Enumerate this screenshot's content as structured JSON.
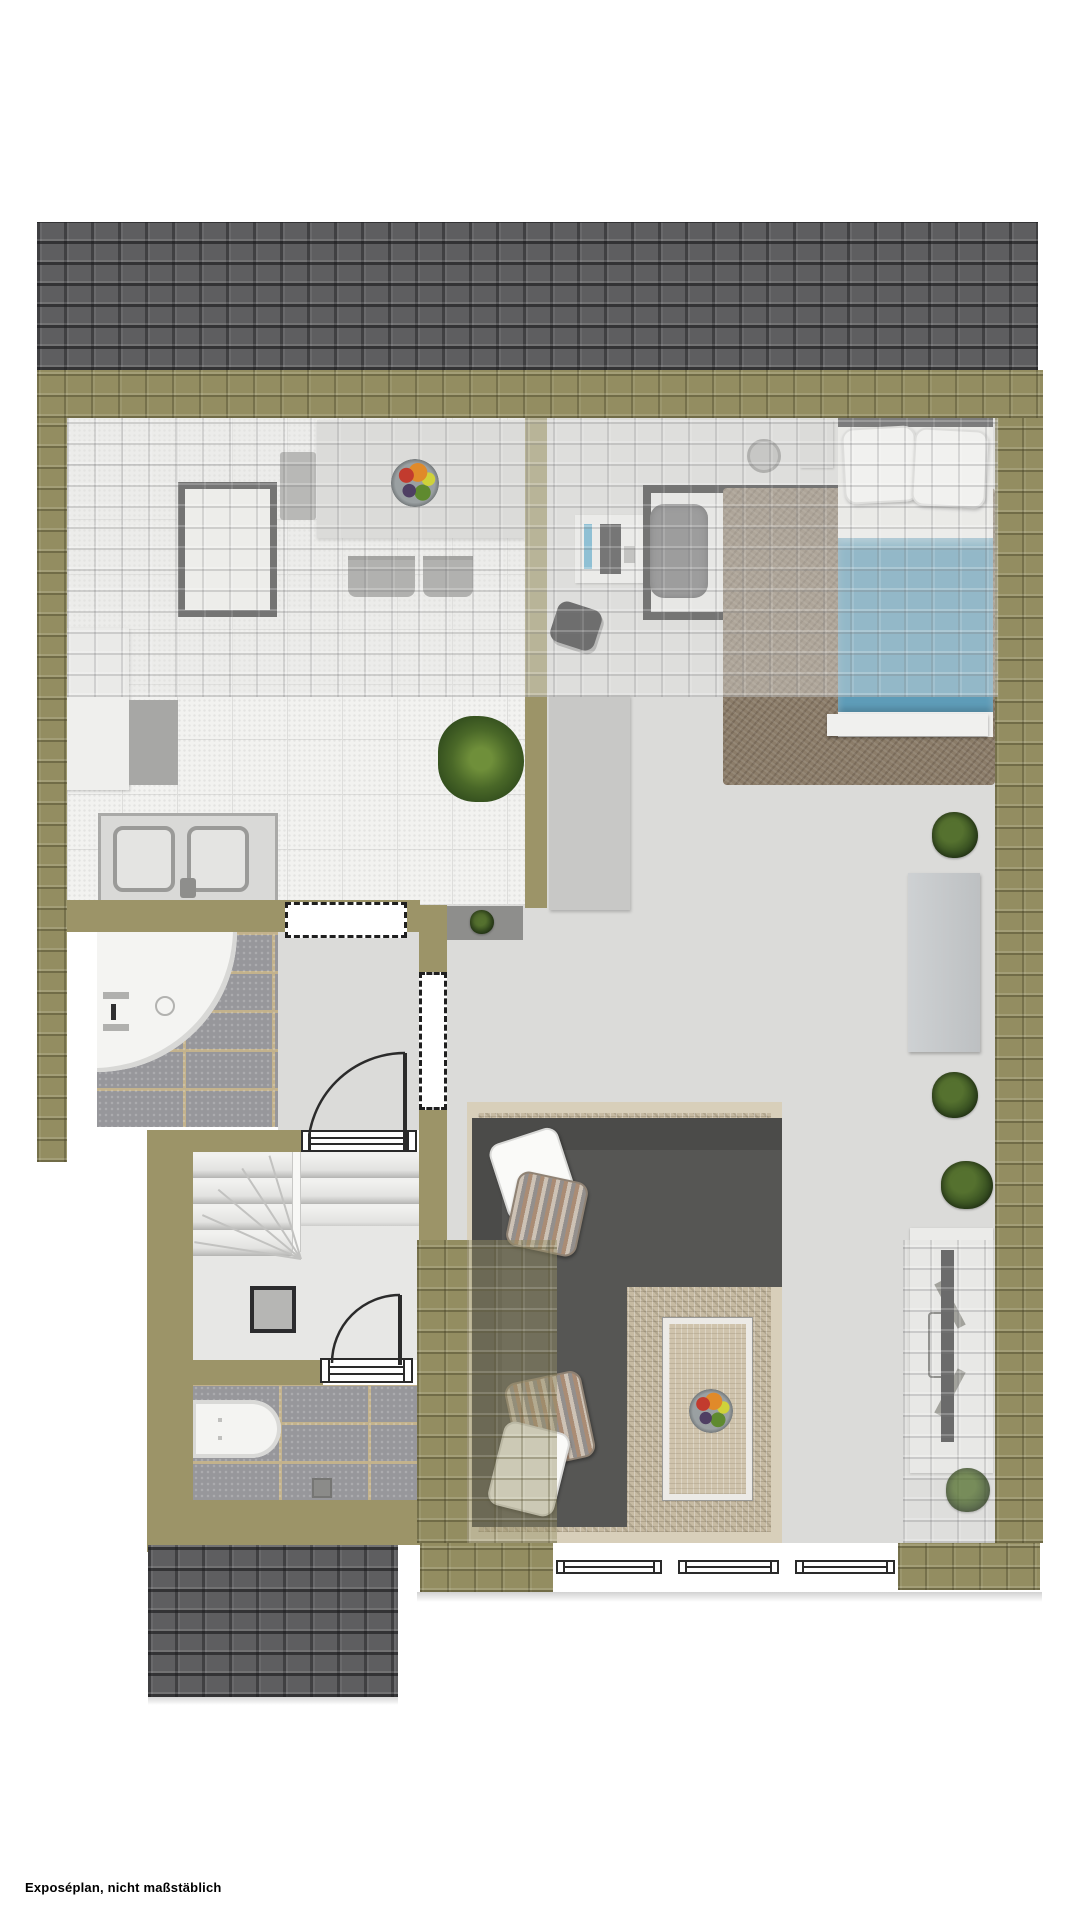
{
  "caption": "Exposéplan, nicht maßstäblich",
  "plan": {
    "type": "attic-floor-plan-top-view",
    "colors": {
      "roof_dark": "#5e5e60",
      "roof_olive": "#938d61",
      "wall_olive": "#9c9468",
      "floor_light": "#dbdbd9",
      "kitchen_tile": "#f2f2f0",
      "stone_tile": "#97979b",
      "bed_blanket_blue": "#5e9cb8",
      "sofa_dark": "#565654",
      "rug_beige": "#c6baa2",
      "rug_brown": "#8b7c69",
      "plant_green": "#3b5423"
    },
    "icon_inventory": [
      "dining-table",
      "kitchen-island",
      "kitchen-sink",
      "potted-plant",
      "shower",
      "bathtub",
      "stairs",
      "door-swing",
      "window",
      "bed",
      "desk",
      "office-chair",
      "sofa",
      "coffee-table",
      "fruit-bowl",
      "tv",
      "sideboard",
      "rug"
    ]
  }
}
